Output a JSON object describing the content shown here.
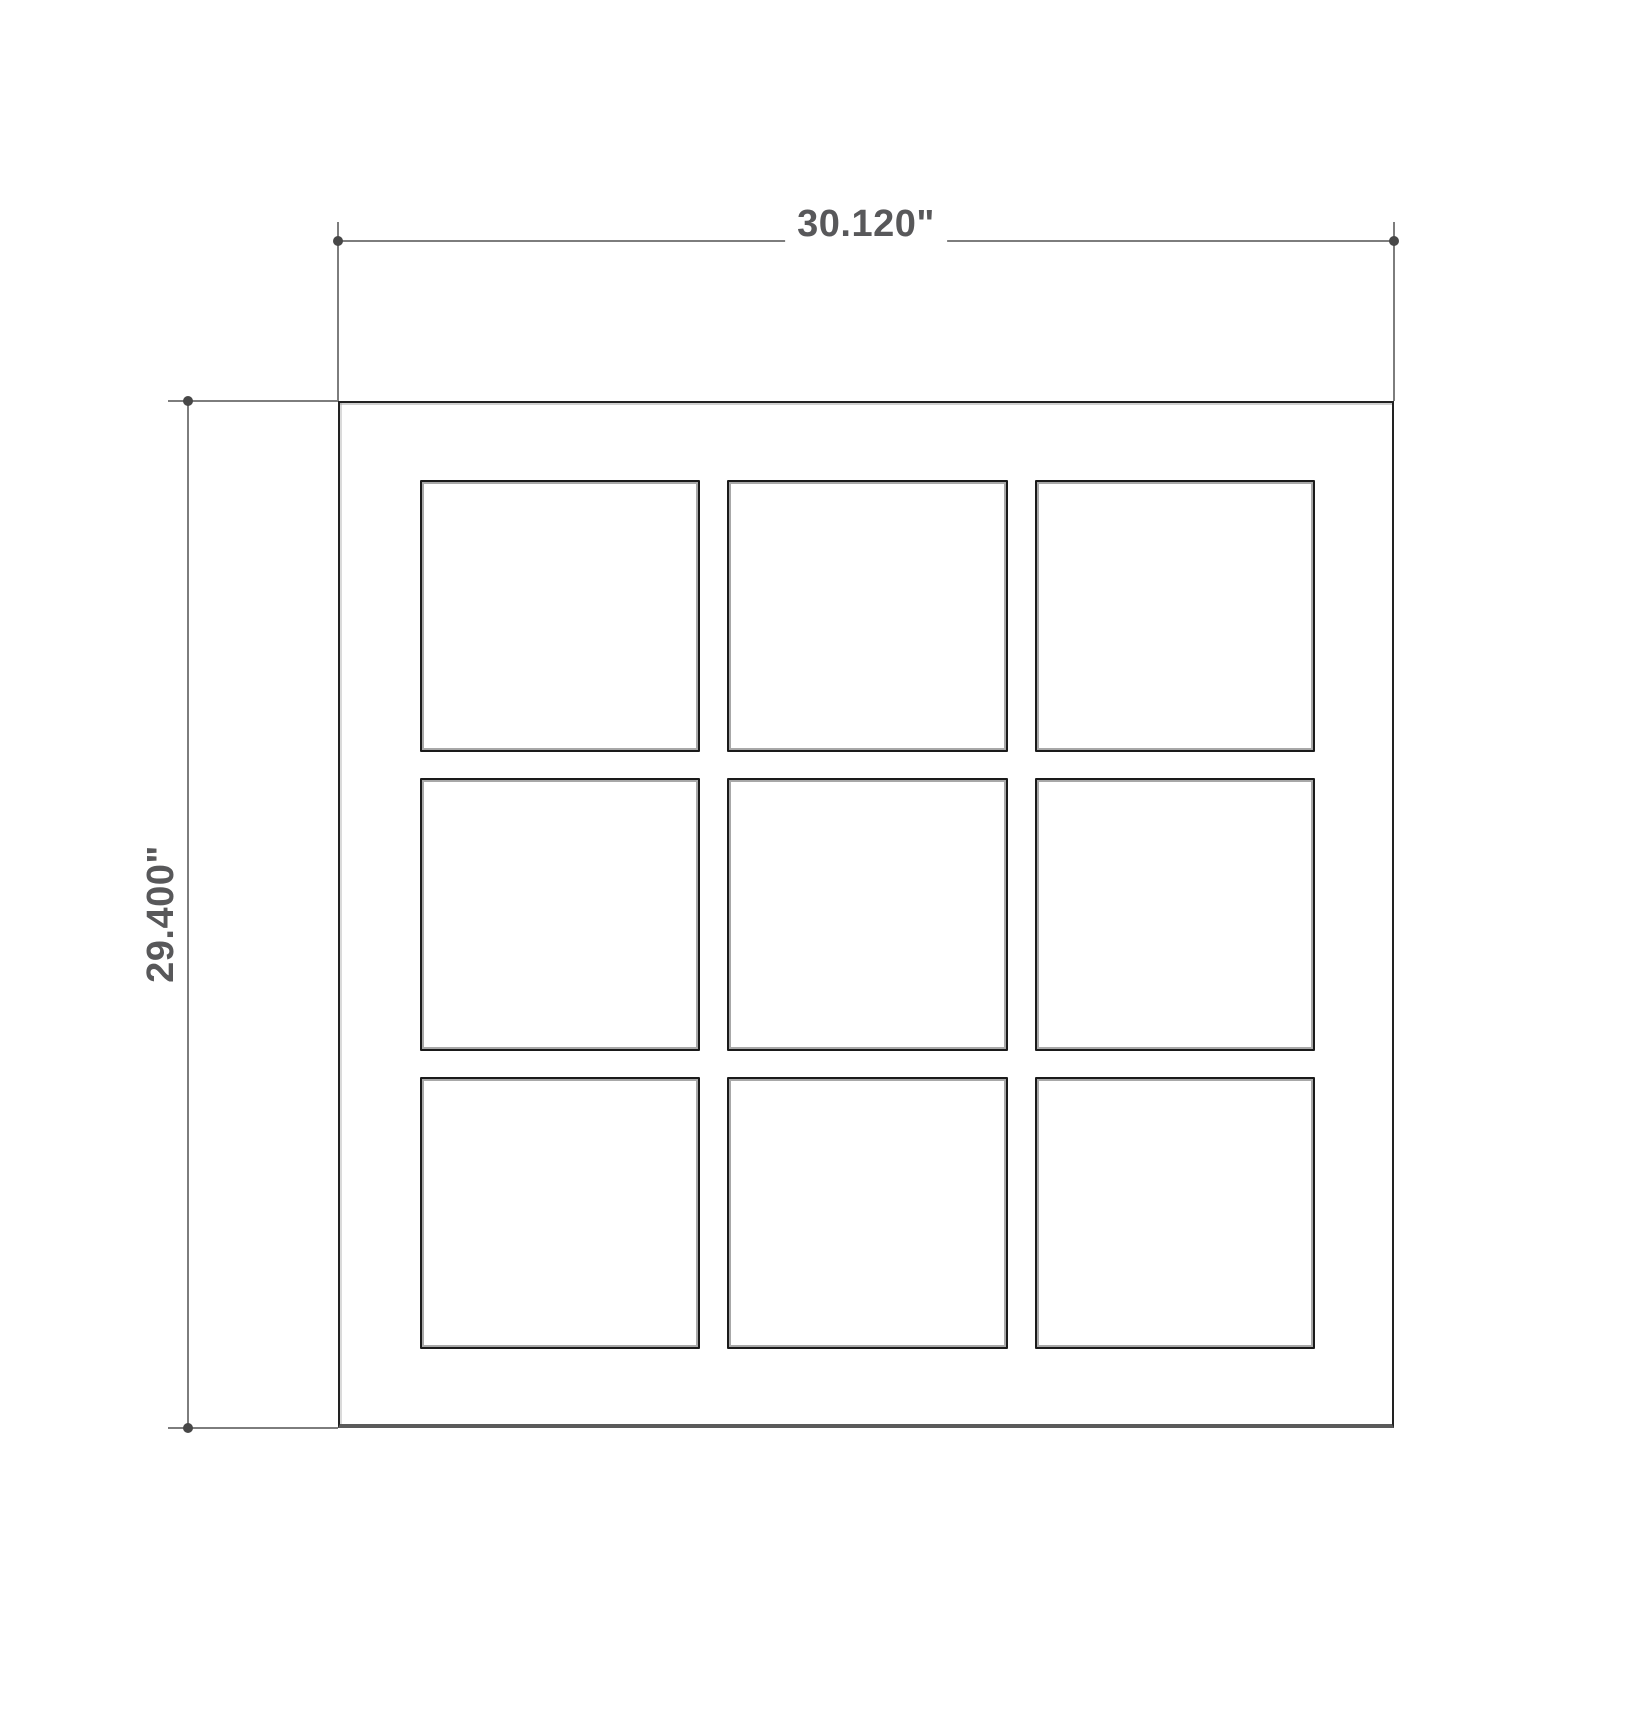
{
  "drawing": {
    "width_label": "30.120\"",
    "height_label": "29.400\"",
    "grid": {
      "rows": 3,
      "cols": 3
    },
    "colors": {
      "background": "#ffffff",
      "dimension_line": "#7d7d7d",
      "dimension_marker": "#474747",
      "dimension_text": "#58585a",
      "object_line": "#222222",
      "object_bottom_line": "#5a5a5a",
      "pane_line": "#1a1a1a",
      "pane_inner_line": "#a8a8a8"
    }
  }
}
